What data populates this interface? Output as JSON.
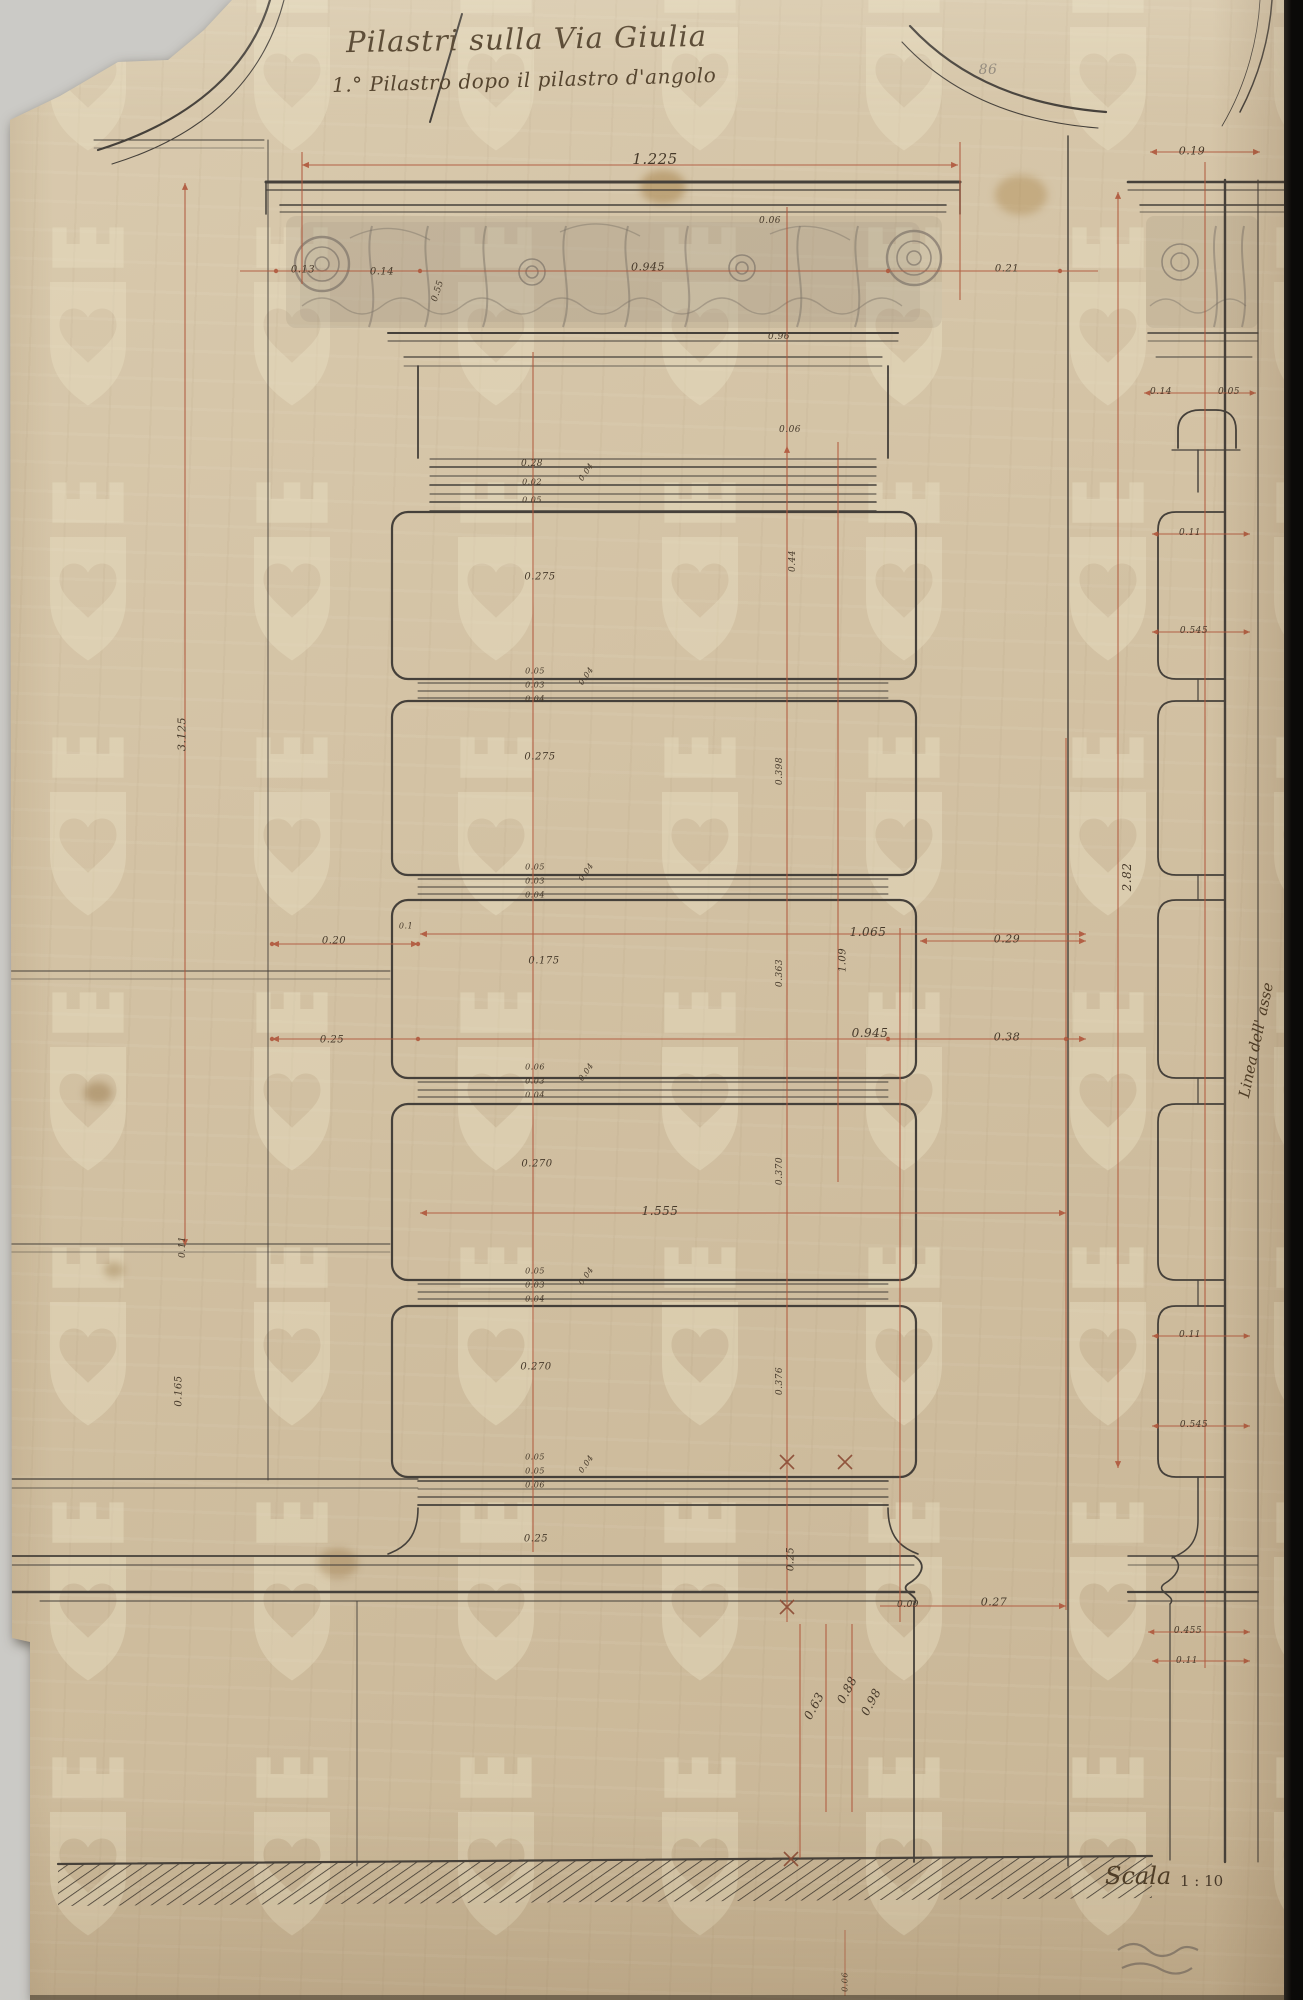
{
  "title": {
    "line1": "Pilastri sulla Via Giulia",
    "line2": "1.° Pilastro dopo il pilastro d'angolo"
  },
  "scale": {
    "label": "Scala",
    "ratio": "1 : 10"
  },
  "side_note": "Linea dell' asse",
  "colors": {
    "paper": "#d3c2a4",
    "ink": "#45403a",
    "dimension_red": "#b0563b",
    "pencil": "#7d7469",
    "backing": "#cbcac6",
    "scan_edge": "#0b0a08",
    "watermark": "#eae1c4"
  },
  "watermark": {
    "motif": "crowned-shield-with-heart",
    "cols": 7,
    "rows": 8
  },
  "annotations": [
    {
      "t": "1.225",
      "x": 655,
      "y": 159,
      "s": 15
    },
    {
      "t": "0.19",
      "x": 1192,
      "y": 151,
      "s": 11
    },
    {
      "t": "86",
      "x": 988,
      "y": 70,
      "s": 14,
      "cls": "pencil"
    },
    {
      "t": "0.13",
      "x": 303,
      "y": 270,
      "s": 10
    },
    {
      "t": "0.14",
      "x": 382,
      "y": 272,
      "s": 10
    },
    {
      "t": "0.945",
      "x": 648,
      "y": 267,
      "s": 11
    },
    {
      "t": "0.21",
      "x": 1007,
      "y": 269,
      "s": 10
    },
    {
      "t": "0.06",
      "x": 770,
      "y": 221,
      "s": 9
    },
    {
      "t": "0.55",
      "x": 438,
      "y": 291,
      "r": -72,
      "s": 9
    },
    {
      "t": "0.96",
      "x": 779,
      "y": 337,
      "s": 9
    },
    {
      "t": "0.06",
      "x": 790,
      "y": 430,
      "s": 9
    },
    {
      "t": "0.28",
      "x": 532,
      "y": 464,
      "s": 9
    },
    {
      "t": "0.02",
      "x": 532,
      "y": 482,
      "s": 8
    },
    {
      "t": "0.05",
      "x": 532,
      "y": 500,
      "s": 8
    },
    {
      "t": "0.04",
      "x": 586,
      "y": 472,
      "r": -55,
      "s": 8
    },
    {
      "t": "0.275",
      "x": 540,
      "y": 577,
      "s": 10
    },
    {
      "t": "0.44",
      "x": 793,
      "y": 561,
      "r": -90,
      "s": 9
    },
    {
      "t": "0.05",
      "x": 535,
      "y": 671,
      "s": 8
    },
    {
      "t": "0.03",
      "x": 535,
      "y": 685,
      "s": 8
    },
    {
      "t": "0.04",
      "x": 535,
      "y": 699,
      "s": 8
    },
    {
      "t": "0.04",
      "x": 586,
      "y": 676,
      "r": -55,
      "s": 8
    },
    {
      "t": "0.275",
      "x": 540,
      "y": 757,
      "s": 10
    },
    {
      "t": "0.398",
      "x": 780,
      "y": 771,
      "r": -90,
      "s": 9
    },
    {
      "t": "0.05",
      "x": 535,
      "y": 867,
      "s": 8
    },
    {
      "t": "0.03",
      "x": 535,
      "y": 881,
      "s": 8
    },
    {
      "t": "0.04",
      "x": 535,
      "y": 895,
      "s": 8
    },
    {
      "t": "0.04",
      "x": 586,
      "y": 872,
      "r": -55,
      "s": 8
    },
    {
      "t": "0.1",
      "x": 406,
      "y": 926,
      "s": 8
    },
    {
      "t": "1.065",
      "x": 868,
      "y": 932,
      "s": 12
    },
    {
      "t": "0.20",
      "x": 334,
      "y": 941,
      "s": 10
    },
    {
      "t": "0.29",
      "x": 1007,
      "y": 939,
      "s": 11
    },
    {
      "t": "0.175",
      "x": 544,
      "y": 961,
      "s": 10
    },
    {
      "t": "0.363",
      "x": 780,
      "y": 973,
      "r": -90,
      "s": 9
    },
    {
      "t": "1.09",
      "x": 843,
      "y": 960,
      "r": -90,
      "s": 10
    },
    {
      "t": "0.945",
      "x": 870,
      "y": 1033,
      "s": 12
    },
    {
      "t": "0.25",
      "x": 332,
      "y": 1040,
      "s": 10
    },
    {
      "t": "0.38",
      "x": 1007,
      "y": 1037,
      "s": 11
    },
    {
      "t": "0.06",
      "x": 535,
      "y": 1067,
      "s": 8
    },
    {
      "t": "0.03",
      "x": 535,
      "y": 1081,
      "s": 8
    },
    {
      "t": "0.04",
      "x": 535,
      "y": 1095,
      "s": 8
    },
    {
      "t": "0.04",
      "x": 586,
      "y": 1072,
      "r": -55,
      "s": 8
    },
    {
      "t": "0.270",
      "x": 537,
      "y": 1164,
      "s": 10
    },
    {
      "t": "0.370",
      "x": 780,
      "y": 1171,
      "r": -90,
      "s": 9
    },
    {
      "t": "1.555",
      "x": 660,
      "y": 1211,
      "s": 12
    },
    {
      "t": "0.05",
      "x": 535,
      "y": 1271,
      "s": 8
    },
    {
      "t": "0.03",
      "x": 535,
      "y": 1285,
      "s": 8
    },
    {
      "t": "0.04",
      "x": 535,
      "y": 1299,
      "s": 8
    },
    {
      "t": "0.04",
      "x": 586,
      "y": 1276,
      "r": -55,
      "s": 8
    },
    {
      "t": "0.270",
      "x": 536,
      "y": 1367,
      "s": 10
    },
    {
      "t": "0.376",
      "x": 780,
      "y": 1381,
      "r": -90,
      "s": 9
    },
    {
      "t": "0.05",
      "x": 535,
      "y": 1457,
      "s": 8
    },
    {
      "t": "0.05",
      "x": 535,
      "y": 1471,
      "s": 8
    },
    {
      "t": "0.06",
      "x": 535,
      "y": 1485,
      "s": 8
    },
    {
      "t": "0.04",
      "x": 586,
      "y": 1464,
      "r": -55,
      "s": 8
    },
    {
      "t": "0.25",
      "x": 536,
      "y": 1539,
      "s": 10
    },
    {
      "t": "0.25",
      "x": 791,
      "y": 1559,
      "r": -90,
      "s": 10
    },
    {
      "t": "3.125",
      "x": 182,
      "y": 734,
      "r": -90,
      "s": 11
    },
    {
      "t": "0.11",
      "x": 183,
      "y": 1247,
      "r": -90,
      "s": 9
    },
    {
      "t": "0.165",
      "x": 179,
      "y": 1391,
      "r": -90,
      "s": 10
    },
    {
      "t": "2.82",
      "x": 1127,
      "y": 877,
      "r": -90,
      "s": 12
    },
    {
      "t": "0.63",
      "x": 814,
      "y": 1706,
      "r": -62,
      "s": 12
    },
    {
      "t": "0.88",
      "x": 847,
      "y": 1690,
      "r": -62,
      "s": 12
    },
    {
      "t": "0.98",
      "x": 871,
      "y": 1702,
      "r": -62,
      "s": 12
    },
    {
      "t": "0.09",
      "x": 908,
      "y": 1605,
      "s": 9
    },
    {
      "t": "0.27",
      "x": 994,
      "y": 1602,
      "s": 11
    },
    {
      "t": "0.06",
      "x": 845,
      "y": 1982,
      "r": -90,
      "s": 8
    },
    {
      "t": "0.14",
      "x": 1161,
      "y": 392,
      "s": 9
    },
    {
      "t": "0.05",
      "x": 1229,
      "y": 392,
      "s": 9
    },
    {
      "t": "0.11",
      "x": 1190,
      "y": 533,
      "s": 9
    },
    {
      "t": "0.545",
      "x": 1194,
      "y": 631,
      "s": 9
    },
    {
      "t": "0.11",
      "x": 1190,
      "y": 1335,
      "s": 9
    },
    {
      "t": "0.545",
      "x": 1194,
      "y": 1425,
      "s": 9
    },
    {
      "t": "0.455",
      "x": 1188,
      "y": 1631,
      "s": 9
    },
    {
      "t": "0.11",
      "x": 1187,
      "y": 1661,
      "s": 9
    }
  ]
}
